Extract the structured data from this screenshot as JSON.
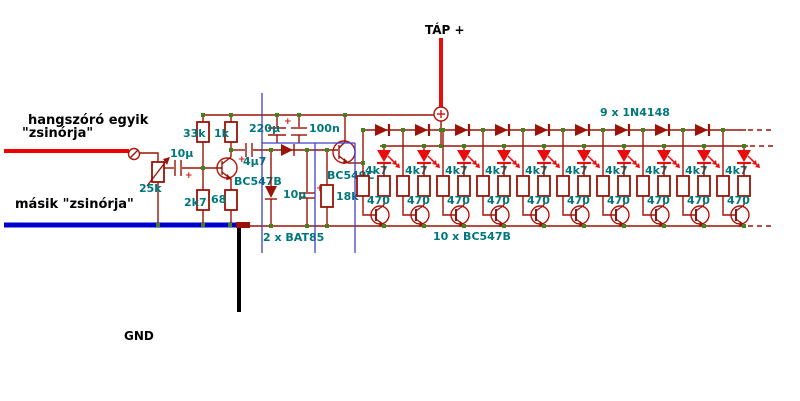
{
  "title": "speaker-driven LED level meter schematic",
  "colors": {
    "wire": "#9b1206",
    "bright_red": "#e80c0c",
    "teal_label": "#00777c",
    "junction_dot": "#44801c",
    "annotation_blue": "#4040c8",
    "speaker_hot_wire": "#ee0000",
    "speaker_gnd_wire": "#0000cc",
    "gnd_drop": "#000000"
  },
  "left_labels": {
    "speaker_line1": "hangszóró egyik",
    "speaker_line2": "\"zsinórja\"",
    "other_lead": "másik \"zsinórja\"",
    "gnd": "GND"
  },
  "input_stage": {
    "pot": "25k",
    "input_cap": "10µ",
    "plus": "+",
    "r_base_upper": "33k",
    "r_base_lower": "2k7",
    "r_collector": "1k",
    "r_emitter": "68",
    "transistor": "BC547B"
  },
  "detector_stage": {
    "filter_cap_big": "220µ",
    "filter_cap_small": "100n",
    "coupling_cap": "4µ7",
    "rectifier_note": "2 x BAT85",
    "smoothing_cap": "10µ",
    "load_resistor": "18k",
    "transistor": "BC549C",
    "plus": "+"
  },
  "led_array": {
    "supply_label": "TÁP +",
    "diode_chain_note": "9 x 1N4148",
    "transistor_note": "10 x BC547B",
    "stage_base_resistor": "4k7",
    "stage_led_resistor": "470",
    "stage_count": 10,
    "diode_count": 9
  }
}
